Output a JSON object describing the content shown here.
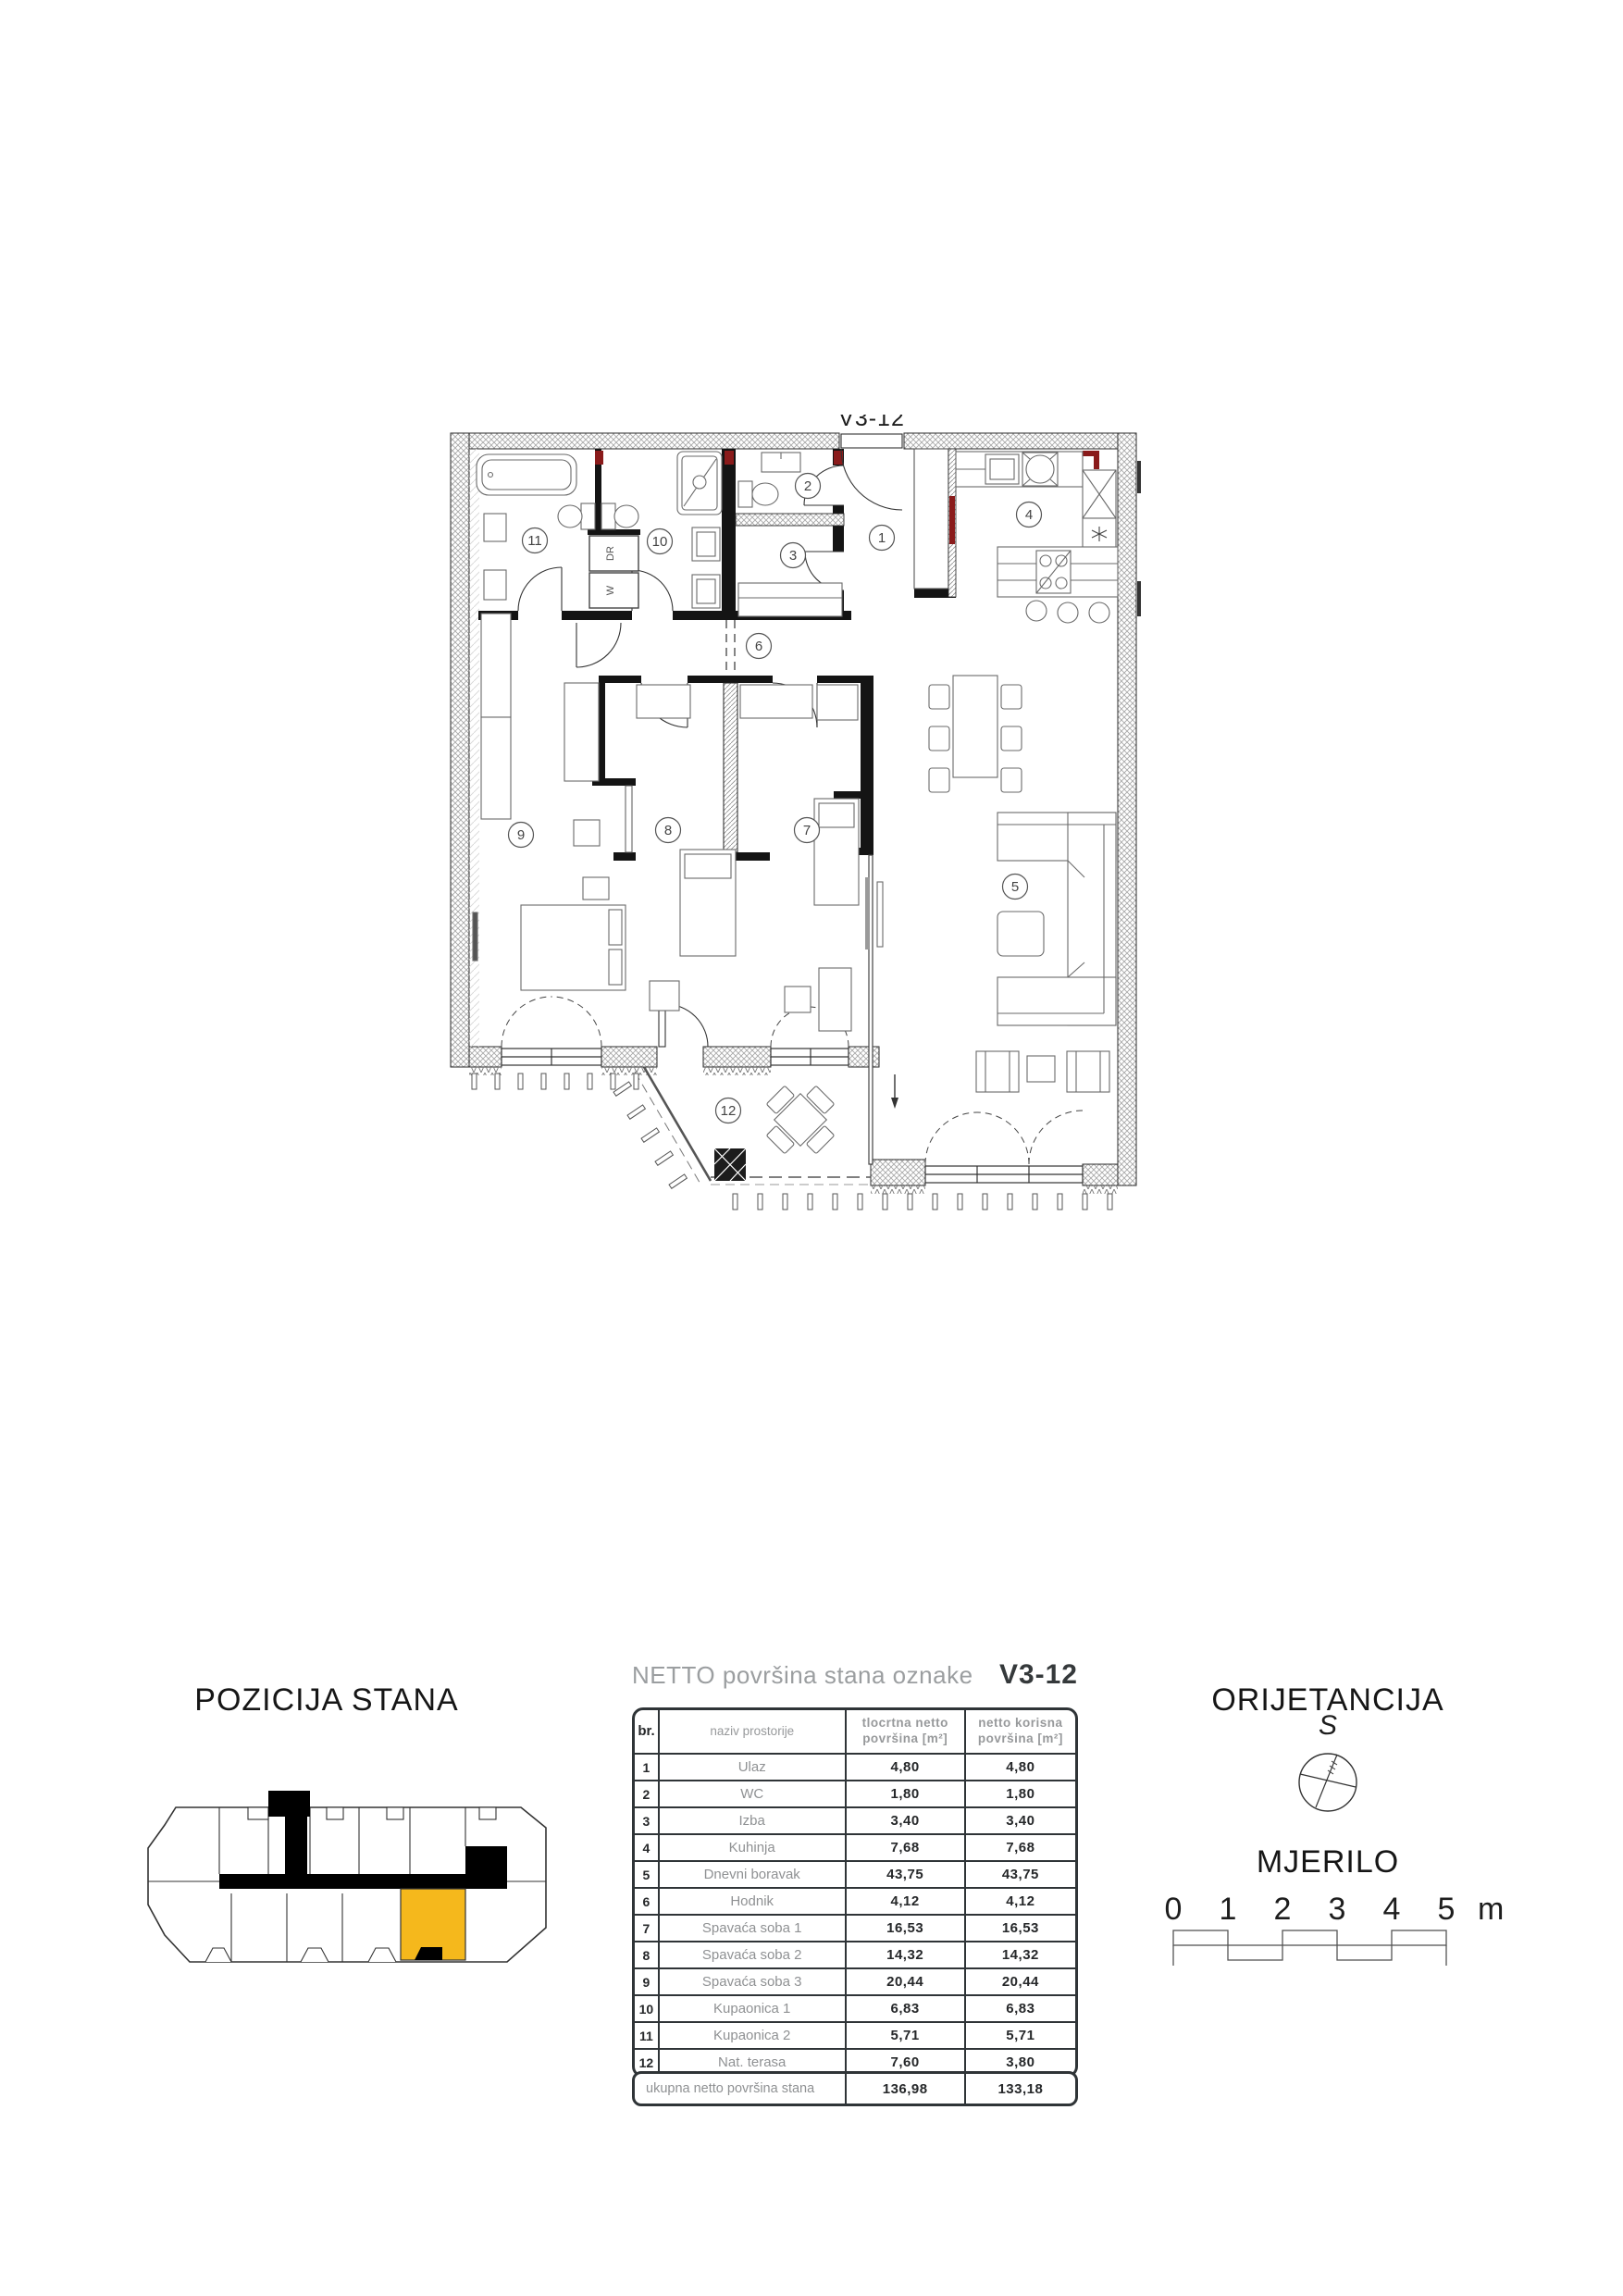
{
  "floorplan": {
    "unit_label": "V3-12",
    "room_numbers": [
      "1",
      "2",
      "3",
      "4",
      "5",
      "6",
      "7",
      "8",
      "9",
      "10",
      "11",
      "12"
    ],
    "washer_label": "W",
    "dryer_label": "DR",
    "accent_red": "#8a1b1b",
    "highlight_color": "#F5B81C"
  },
  "position_section": {
    "title": "POZICIJA STANA"
  },
  "table_section": {
    "title_prefix": "NETTO površina stana oznake",
    "title_unit": "V3-12",
    "headers": {
      "num": "br.",
      "name": "naziv prostorije",
      "floor_area": "tlocrtna netto površina [m²]",
      "usable_area": "netto korisna površina [m²]"
    },
    "rows": [
      {
        "num": "1",
        "name": "Ulaz",
        "floor": "4,80",
        "usable": "4,80"
      },
      {
        "num": "2",
        "name": "WC",
        "floor": "1,80",
        "usable": "1,80"
      },
      {
        "num": "3",
        "name": "Izba",
        "floor": "3,40",
        "usable": "3,40"
      },
      {
        "num": "4",
        "name": "Kuhinja",
        "floor": "7,68",
        "usable": "7,68"
      },
      {
        "num": "5",
        "name": "Dnevni boravak",
        "floor": "43,75",
        "usable": "43,75"
      },
      {
        "num": "6",
        "name": "Hodnik",
        "floor": "4,12",
        "usable": "4,12"
      },
      {
        "num": "7",
        "name": "Spavaća soba 1",
        "floor": "16,53",
        "usable": "16,53"
      },
      {
        "num": "8",
        "name": "Spavaća soba 2",
        "floor": "14,32",
        "usable": "14,32"
      },
      {
        "num": "9",
        "name": "Spavaća soba 3",
        "floor": "20,44",
        "usable": "20,44"
      },
      {
        "num": "10",
        "name": "Kupaonica 1",
        "floor": "6,83",
        "usable": "6,83"
      },
      {
        "num": "11",
        "name": "Kupaonica 2",
        "floor": "5,71",
        "usable": "5,71"
      },
      {
        "num": "12",
        "name": "Nat. terasa",
        "floor": "7,60",
        "usable": "3,80"
      }
    ],
    "total": {
      "label": "ukupna netto površina stana",
      "floor": "136,98",
      "usable": "133,18"
    }
  },
  "orientation_section": {
    "title": "ORIJETANCIJA",
    "north_letter": "S"
  },
  "scale_section": {
    "title": "MJERILO",
    "labels": [
      "0",
      "1",
      "2",
      "3",
      "4",
      "5"
    ],
    "unit": "m"
  }
}
